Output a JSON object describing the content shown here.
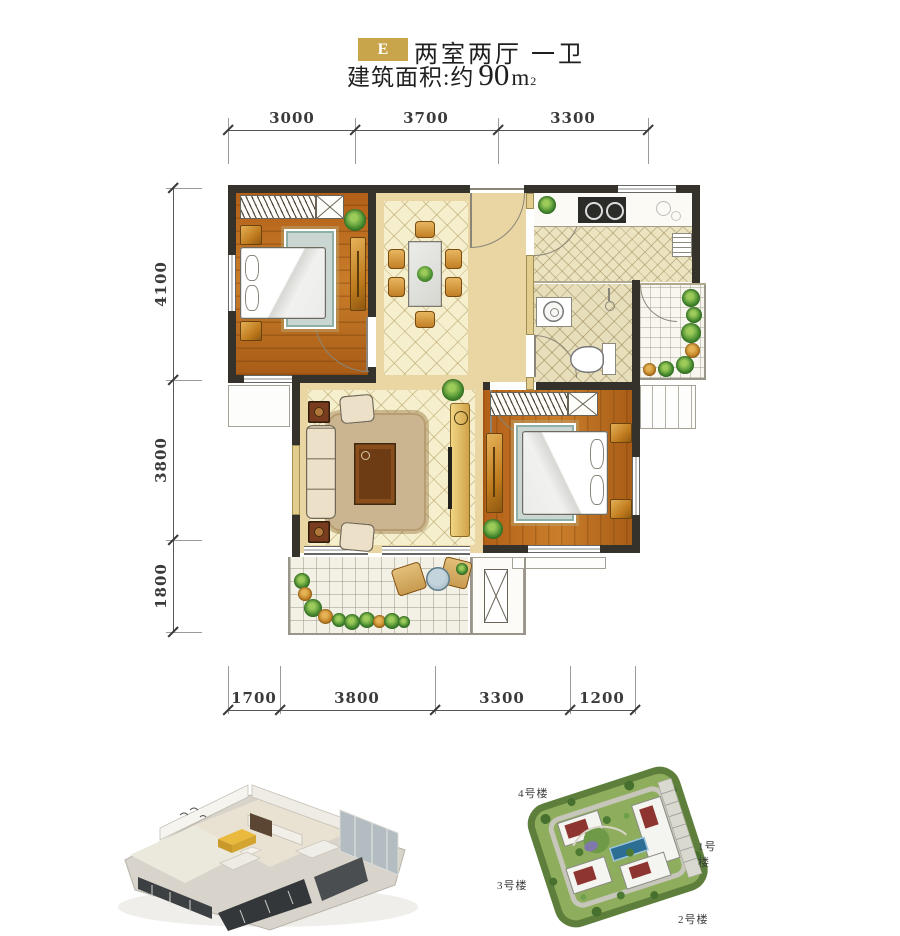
{
  "header": {
    "badge": "E",
    "unit_type": "两室两厅 一卫",
    "area_label": "建筑面积:约",
    "area_value": "90",
    "area_unit": "m",
    "area_exp": "2"
  },
  "dimensions": {
    "top": [
      "3000",
      "3700",
      "3300"
    ],
    "left": [
      "4100",
      "3800",
      "1800"
    ],
    "bottom": [
      "1700",
      "3800",
      "3300",
      "1200"
    ]
  },
  "site_map": {
    "building_4": "4号楼",
    "building_1": "1号楼",
    "building_3": "3号楼",
    "building_2": "2号楼"
  },
  "colors": {
    "badge_gold": "#c8a44b",
    "wall_dark": "#35322c",
    "wall_infill": "#e3cd8c",
    "wood_floor": "#b4661e",
    "tile_cream": "#f5eecb",
    "rug_teal": "#c6d4cf",
    "site_green": "#8fae5d",
    "pool_blue": "#2d6e95",
    "roof_red": "#8e3531"
  }
}
